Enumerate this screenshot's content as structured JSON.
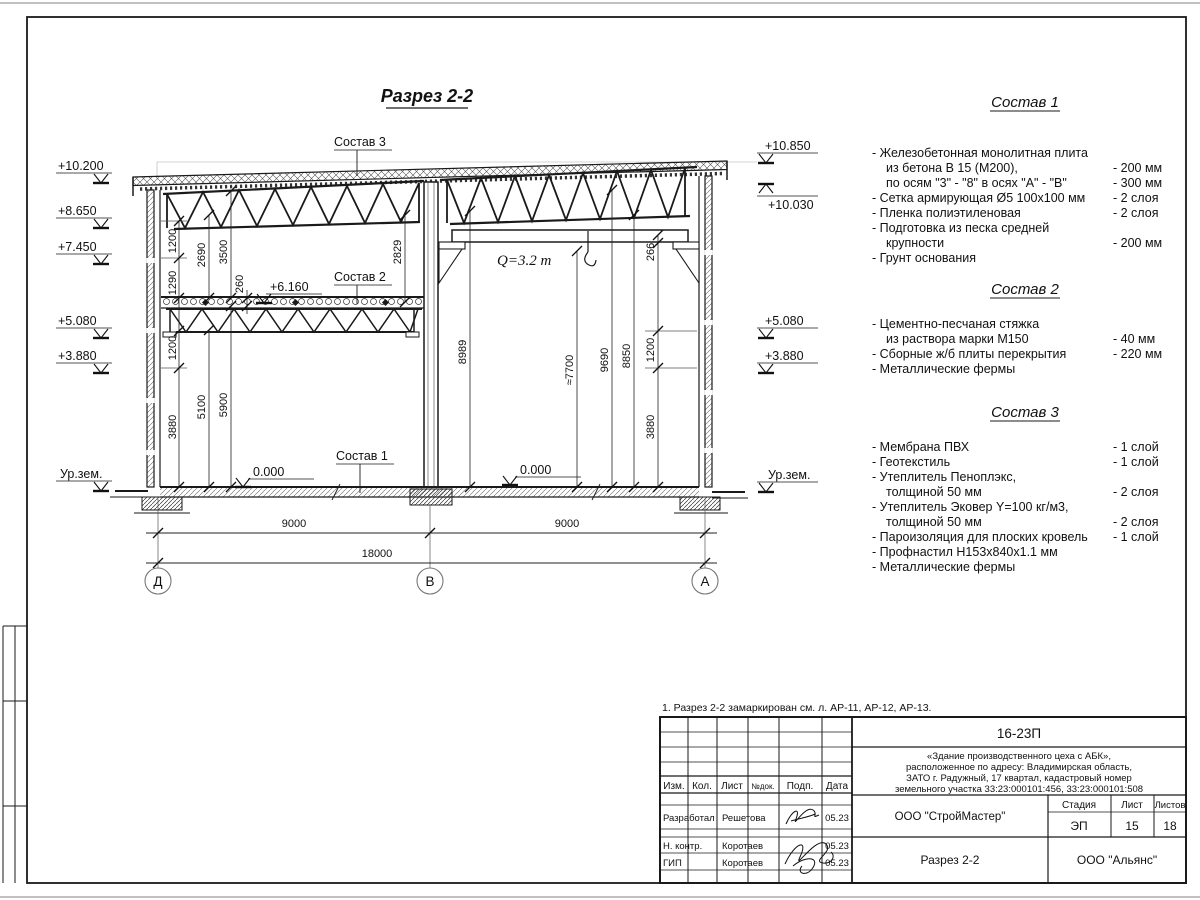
{
  "sheet": {
    "title": "Разрез 2-2",
    "note": "1. Разрез 2-2 замаркирован см. л. АР-11, АР-12, АР-13.",
    "paper_color": "#ffffff",
    "ink_color": "#1a1a1a"
  },
  "drawing": {
    "levels_left": [
      "+10.200",
      "+8.650",
      "+7.450",
      "+5.080",
      "+3.880",
      "Ур.зем."
    ],
    "levels_right": [
      "+10.850",
      "+10.030",
      "+5.080",
      "+3.880",
      "Ур.зем."
    ],
    "level_mezzanine": "+6.160",
    "floor_level": "0.000",
    "crane_capacity": "Q=3.2 т",
    "leaders": [
      "Состав 1",
      "Состав 2",
      "Состав 3"
    ],
    "dims_left": [
      "1200",
      "1290",
      "1200",
      "3880",
      "2690",
      "5100",
      "3500",
      "5900",
      "260",
      "2829"
    ],
    "dims_right": [
      "8989",
      "≈7700",
      "9690",
      "8850",
      "266",
      "1200",
      "3880"
    ],
    "spans": [
      "9000",
      "9000"
    ],
    "total_span": "18000",
    "axes": [
      "Д",
      "В",
      "А"
    ]
  },
  "compositions": [
    {
      "title": "Состав 1",
      "rows": [
        {
          "t": "- Железобетонная  монолитная плита",
          "v": ""
        },
        {
          "t": "из бетона В 15 (М200),",
          "v": "- 200 мм"
        },
        {
          "t": "по осям \"3\" - \"8\" в осях \"А\" - \"В\"",
          "v": "- 300 мм"
        },
        {
          "t": "- Сетка армирующая Ø5 100х100 мм",
          "v": "- 2 слоя"
        },
        {
          "t": "- Пленка полиэтиленовая",
          "v": "- 2 слоя"
        },
        {
          "t": "- Подготовка из песка средней",
          "v": ""
        },
        {
          "t": "крупности",
          "v": "- 200 мм"
        },
        {
          "t": "- Грунт основания",
          "v": ""
        }
      ]
    },
    {
      "title": "Состав 2",
      "rows": [
        {
          "t": "- Цементно-песчаная стяжка",
          "v": ""
        },
        {
          "t": "из раствора марки М150",
          "v": "- 40 мм"
        },
        {
          "t": "- Сборные ж/б плиты перекрытия",
          "v": "- 220 мм"
        },
        {
          "t": "- Металлические фермы",
          "v": ""
        }
      ]
    },
    {
      "title": "Состав 3",
      "rows": [
        {
          "t": "- Мембрана ПВХ",
          "v": "- 1 слой"
        },
        {
          "t": "- Геотекстиль",
          "v": "- 1 слой"
        },
        {
          "t": "- Утеплитель Пеноплэкс,",
          "v": ""
        },
        {
          "t": "толщиной 50 мм",
          "v": "- 2 слоя"
        },
        {
          "t": "- Утеплитель Эковер Y=100 кг/м3,",
          "v": ""
        },
        {
          "t": "толщиной 50 мм",
          "v": "- 2 слоя"
        },
        {
          "t": "- Пароизоляция для плоских кровель",
          "v": "- 1 слой"
        },
        {
          "t": "- Профнастил Н153х840х1.1 мм",
          "v": ""
        },
        {
          "t": "- Металлические фермы",
          "v": ""
        }
      ]
    }
  ],
  "titleblock": {
    "doc_number": "16-23П",
    "desc_lines": [
      "«Здание производственного цеха с АБК»,",
      "расположенное по адресу: Владимирская область,",
      "ЗАТО г. Радужный, 17 квартал, кадастровый номер",
      "земельного участка 33:23:000101:456, 33:23:000101:508"
    ],
    "cols": [
      "Изм.",
      "Кол.",
      "Лист",
      "№док.",
      "Подп.",
      "Дата"
    ],
    "sign_rows": [
      {
        "role": "Разработал",
        "name": "Решетова",
        "date": "05.23"
      },
      {
        "role": "Н. контр.",
        "name": "Коротаев",
        "date": "05.23"
      },
      {
        "role": "ГИП",
        "name": "Коротаев",
        "date": "05.23"
      }
    ],
    "org_developer": "ООО \"СтройМастер\"",
    "org_customer": "ООО \"Альянс\"",
    "stage_cols": [
      "Стадия",
      "Лист",
      "Листов"
    ],
    "stage": "ЭП",
    "sheet_no": "15",
    "sheets_total": "18",
    "drawing_name": "Разрез 2-2"
  }
}
